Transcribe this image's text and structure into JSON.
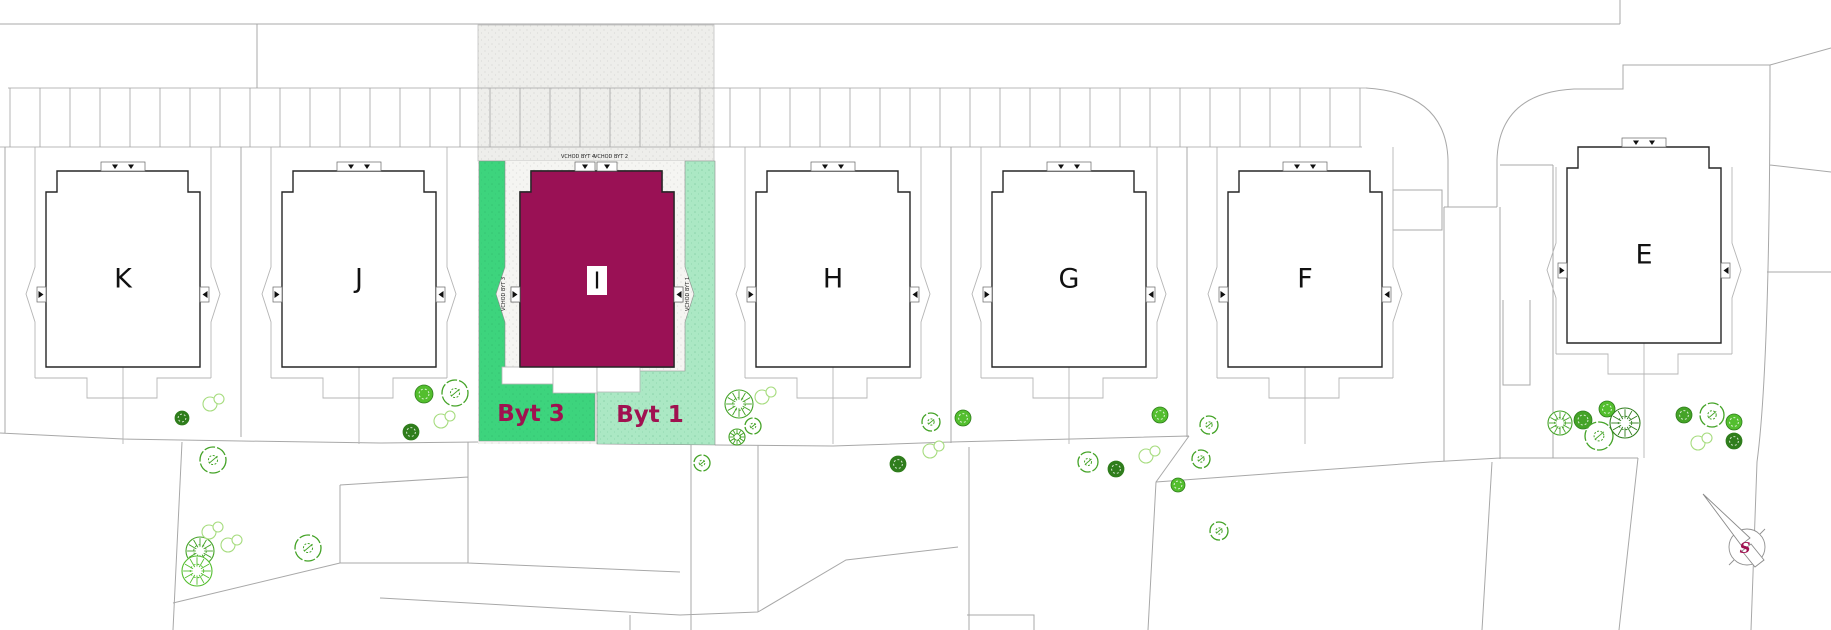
{
  "buildings": [
    {
      "label": "K"
    },
    {
      "label": "J"
    },
    {
      "label": "I"
    },
    {
      "label": "H"
    },
    {
      "label": "G"
    },
    {
      "label": "F"
    },
    {
      "label": "E"
    }
  ],
  "building_i": {
    "label": "I",
    "entrance_top_left": "VCHOD BYT 4",
    "entrance_top_right": "VCHOD BYT 2",
    "entrance_side_left": "VCHOD BYT 3",
    "entrance_side_right": "VCHOD BYT 1",
    "unit_left_label": "Byt 3",
    "unit_right_label": "Byt 1"
  },
  "compass": {
    "north_label": "S"
  },
  "colors": {
    "highlight_magenta": "#9A1155",
    "byt3_green": "#3DD47D",
    "byt1_green": "#ABE8C4",
    "label_magenta": "#A01150",
    "paving_gray": "#EEEEEB",
    "parcel_line": "#A8A8A8",
    "building_outline": "#262626",
    "tree_bright": "#53BE2E",
    "tree_mid": "#44A327",
    "tree_dark": "#2F7D1C",
    "tree_light": "#A6DC7E"
  }
}
